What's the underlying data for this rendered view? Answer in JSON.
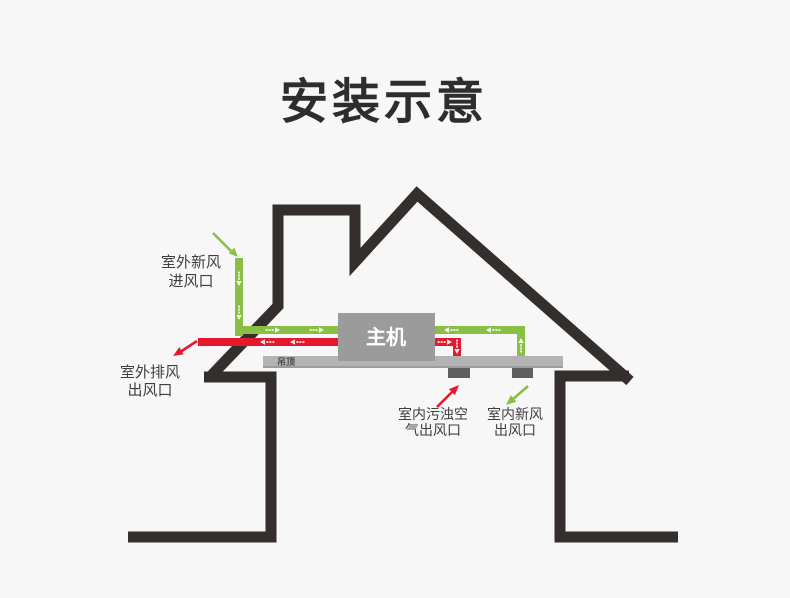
{
  "title": "安装示意",
  "diagram": {
    "main_unit_label": "主机",
    "ceiling_label": "吊顶",
    "labels": {
      "outdoor_fresh": {
        "line1": "室外新风",
        "line2": "进风口"
      },
      "outdoor_exhaust": {
        "line1": "室外排风",
        "line2": "出风口"
      },
      "indoor_dirty": {
        "line1": "室内污浊空",
        "line2": "气出风口"
      },
      "indoor_fresh": {
        "line1": "室内新风",
        "line2": "出风口"
      }
    },
    "colors": {
      "background": "#f7f7f7",
      "house_outline": "#342e2c",
      "fresh_air_green": "#8abf45",
      "exhaust_red": "#e6182e",
      "main_unit_gray": "#9b9b9b",
      "ceiling_gray": "#b3b3b3",
      "ceiling_edge_gray": "#9c9c9c",
      "vent_gray": "#5f5f5f",
      "flow_arrow_white": "#ffffff",
      "title_text": "#2d2d2d",
      "label_text": "#3f3f3f",
      "ceiling_text": "#4a4a4a",
      "unit_text": "#ffffff"
    }
  }
}
